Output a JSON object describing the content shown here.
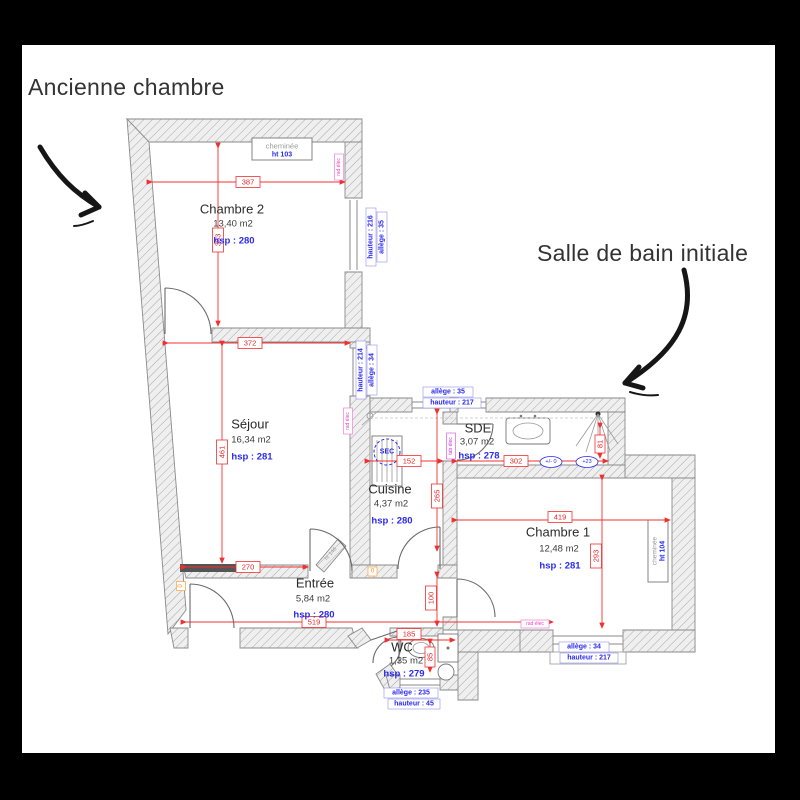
{
  "annotations": {
    "left": "Ancienne chambre",
    "right": "Salle de bain initiale"
  },
  "rooms": {
    "chambre2": {
      "name": "Chambre 2",
      "area": "13,40 m2",
      "hsp": "hsp : 280"
    },
    "sejour": {
      "name": "Séjour",
      "area": "16,34 m2",
      "hsp": "hsp : 281"
    },
    "cuisine": {
      "name": "Cuisine",
      "area": "4,37 m2",
      "hsp": "hsp : 280"
    },
    "sde": {
      "name": "SDE",
      "area": "3,07 m2",
      "hsp": "hsp : 278"
    },
    "chambre1": {
      "name": "Chambre 1",
      "area": "12,48 m2",
      "hsp": "hsp : 281"
    },
    "entree": {
      "name": "Entrée",
      "area": "5,84 m2",
      "hsp": "hsp : 280"
    },
    "wc": {
      "name": "WC",
      "area": "1,35 m2",
      "hsp": "hsp : 279"
    }
  },
  "dims": {
    "d387": "387",
    "d353": "353",
    "d372": "372",
    "d461": "461",
    "d270": "270",
    "d152": "152",
    "d302": "302",
    "d265": "265",
    "d419": "419",
    "d293": "293",
    "d100": "100",
    "d519": "519",
    "d185": "185",
    "d85": "85",
    "d81": "81"
  },
  "windows": {
    "ch2": [
      "allège : 35",
      "hauteur : 216"
    ],
    "sejour": [
      "allège : 34",
      "hauteur : 214"
    ],
    "sde": [
      "allège : 35",
      "hauteur : 217"
    ],
    "ch1": [
      "allège : 34",
      "hauteur : 217"
    ],
    "wc": [
      "allège : 235",
      "hauteur : 45"
    ]
  },
  "features": {
    "cheminee2": "cheminée",
    "cheminee2_ht": "ht 103",
    "cheminee1": "cheminée",
    "cheminee1_ht": "ht 104",
    "sec": "SEC",
    "rad_elec": "rad élec",
    "tab_elec": "tab élec",
    "ht146": "ht 146",
    "level_zero": "+/- 0",
    "level_plus23": "+23",
    "zero_marker": "0"
  },
  "colors": {
    "dim_red": "#f03030",
    "label_blue": "#2a2af0",
    "pink": "#f040c0",
    "magenta": "#c033d8",
    "orange": "#ff8820",
    "wall_gray": "#9a9a9a",
    "annotation_black": "#333333",
    "background": "#000000",
    "sheet": "#ffffff"
  }
}
